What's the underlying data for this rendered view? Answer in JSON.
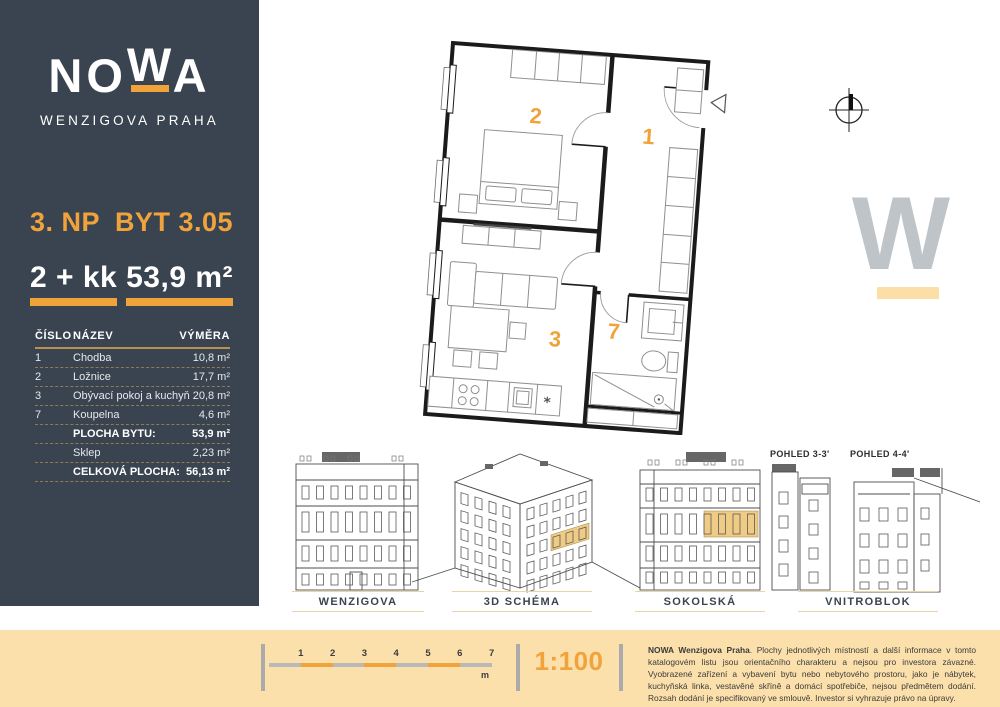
{
  "brand": {
    "letters": [
      "N",
      "O",
      "W",
      "A"
    ],
    "subtitle": "WENZIGOVA PRAHA"
  },
  "unit": {
    "floor": "3. NP",
    "id": "BYT 3.05",
    "disposition": "2 + kk",
    "area": "53,9 m²"
  },
  "table": {
    "headers": [
      "ČÍSLO",
      "NÁZEV",
      "VÝMĚRA"
    ],
    "rows": [
      {
        "num": "1",
        "name": "Chodba",
        "area": "10,8 m²",
        "bold": false
      },
      {
        "num": "2",
        "name": "Ložnice",
        "area": "17,7 m²",
        "bold": false
      },
      {
        "num": "3",
        "name": "Obývací pokoj a kuchyň",
        "area": "20,8 m²",
        "bold": false
      },
      {
        "num": "7",
        "name": "Koupelna",
        "area": "4,6 m²",
        "bold": false
      },
      {
        "num": "",
        "name": "PLOCHA BYTU:",
        "area": "53,9 m²",
        "bold": true
      },
      {
        "num": "",
        "name": "Sklep",
        "area": "2,23 m²",
        "bold": false
      },
      {
        "num": "",
        "name": "CELKOVÁ PLOCHA:",
        "area": "56,13 m²",
        "bold": true
      }
    ]
  },
  "floorplan": {
    "rooms": {
      "hallway": "1",
      "bedroom": "2",
      "living": "3",
      "bath": "7"
    }
  },
  "watermark": {
    "letter": "W"
  },
  "elevations": {
    "labels": [
      "WENZIGOVA",
      "3D SCHÉMA",
      "SOKOLSKÁ",
      "VNITROBLOK"
    ],
    "sections": [
      "POHLED 3-3'",
      "POHLED 4-4'"
    ]
  },
  "footer": {
    "scale_ticks": [
      "1",
      "2",
      "3",
      "4",
      "5",
      "6",
      "7"
    ],
    "scale_unit": "m",
    "scale": "1:100",
    "disclaimer_bold": "NOWA Wenzigova Praha",
    "disclaimer_text": ". Plochy jednotlivých místností a další informace v tomto katalogovém listu jsou orientačního charakteru a nejsou pro investora závazné. Vyobrazené zařízení a vybavení bytu nebo nebytového prostoru, jako je nábytek, kuchyňská linka, vestavěné skříně a domácí spotřebiče, nejsou předmětem dodání. Rozsah dodání je specifikovaný ve smlouvě. Investor si vyhrazuje právo na úpravy."
  },
  "colors": {
    "accent": "#F1A33B",
    "panel": "#3A4450",
    "cream": "#FBE0AC",
    "wm": "#BEC4C8",
    "wmbar": "#FBDFA6",
    "tan": "#E6D5A9",
    "highlight": "#EFCB86"
  }
}
